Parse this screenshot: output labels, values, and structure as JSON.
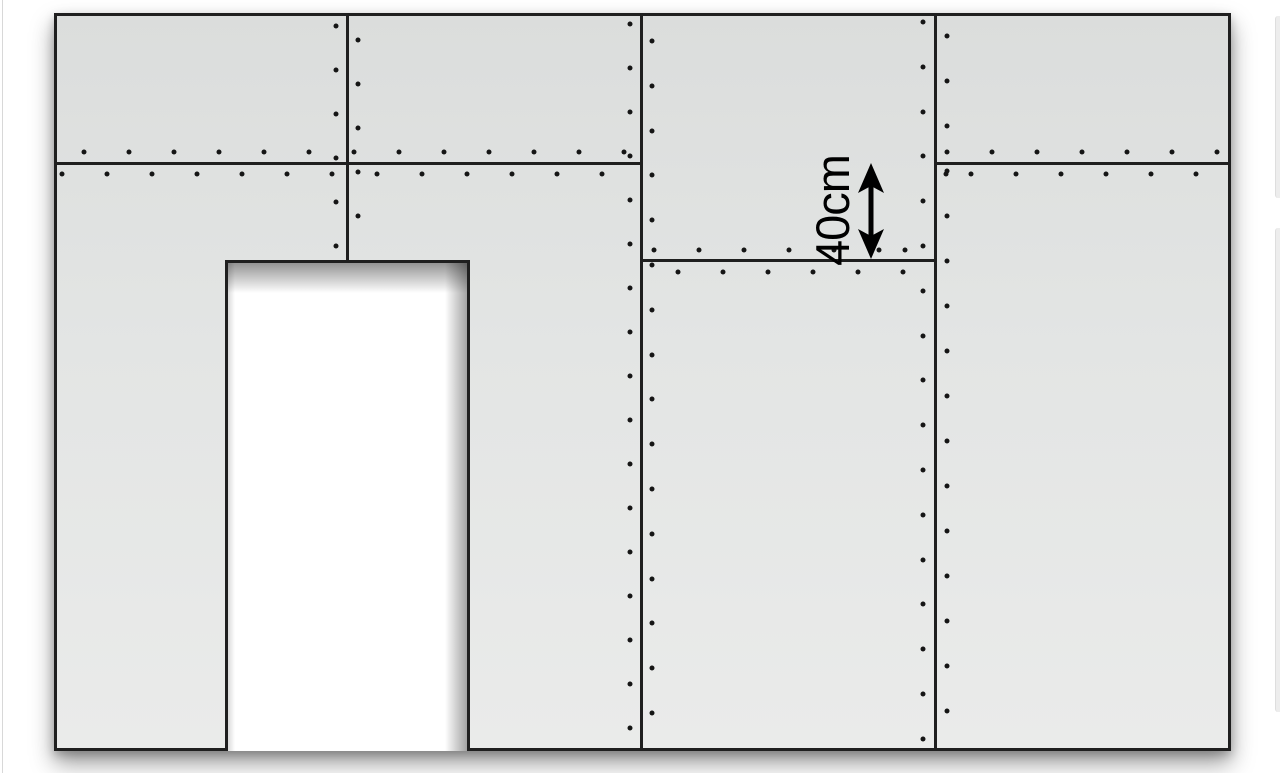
{
  "dimension": {
    "label": "40cm"
  },
  "diagram": {
    "canvas": {
      "width": 1280,
      "height": 773,
      "background": "#ffffff"
    },
    "wall": {
      "x": 54,
      "y": 13,
      "width": 1177,
      "height": 738,
      "fill_top": "#dbdddc",
      "fill_mid": "#e3e5e4",
      "fill_bottom": "#eaebea",
      "line_color": "#1f1f1f",
      "line_width": 3,
      "shadow": "0 12px 22px rgba(0,0,0,0.40), 0 4px 9px rgba(0,0,0,0.22)"
    },
    "door": {
      "x": 225,
      "y": 260,
      "width": 245,
      "height": 491,
      "fill": "#ffffff"
    },
    "seams": [
      {
        "orientation": "vertical",
        "pos": 347,
        "from": 13,
        "to": 260
      },
      {
        "orientation": "vertical",
        "pos": 641,
        "from": 13,
        "to": 751
      },
      {
        "orientation": "vertical",
        "pos": 935,
        "from": 13,
        "to": 751
      },
      {
        "orientation": "horizontal",
        "pos": 163,
        "from": 54,
        "to": 641
      },
      {
        "orientation": "horizontal",
        "pos": 163,
        "from": 935,
        "to": 1231
      },
      {
        "orientation": "horizontal",
        "pos": 260,
        "from": 641,
        "to": 935
      }
    ],
    "screws": {
      "color": "#151515",
      "diameter": 5,
      "rows": [
        {
          "axis": "x",
          "at": 152,
          "start": 84,
          "step": 45,
          "count": 13
        },
        {
          "axis": "x",
          "at": 174,
          "start": 62,
          "step": 45,
          "count": 13
        },
        {
          "axis": "x",
          "at": 152,
          "start": 947,
          "step": 45,
          "count": 7
        },
        {
          "axis": "x",
          "at": 174,
          "start": 946,
          "step": 45,
          "count": 1
        },
        {
          "axis": "x",
          "at": 174,
          "start": 971,
          "step": 45,
          "count": 6
        },
        {
          "axis": "x",
          "at": 250,
          "start": 654,
          "step": 45,
          "count": 6
        },
        {
          "axis": "x",
          "at": 250,
          "start": 905,
          "step": 45,
          "count": 1
        },
        {
          "axis": "x",
          "at": 272,
          "start": 678,
          "step": 45,
          "count": 6
        },
        {
          "axis": "y",
          "at": 336,
          "start": 26,
          "step": 44,
          "count": 6
        },
        {
          "axis": "y",
          "at": 358,
          "start": 40,
          "step": 44,
          "count": 5
        },
        {
          "axis": "y",
          "at": 630,
          "start": 24,
          "step": 44,
          "count": 17
        },
        {
          "axis": "y",
          "at": 652,
          "start": 41,
          "step": 44.8,
          "count": 16
        },
        {
          "axis": "y",
          "at": 923,
          "start": 22,
          "step": 44.8,
          "count": 17
        },
        {
          "axis": "y",
          "at": 947,
          "start": 36,
          "step": 45,
          "count": 16
        }
      ]
    },
    "dimension_arrow": {
      "x": 871,
      "top": 162,
      "bottom": 260,
      "head_width": 26,
      "head_length": 30,
      "notch": 7,
      "shaft_width": 5,
      "color": "#000000",
      "label_center_x": 833,
      "label_center_y": 211
    },
    "page_artifacts": {
      "left_edge_line": {
        "x": 2,
        "color": "#d8d8d8"
      },
      "sliver_color": "#ededed",
      "right_slivers": [
        {
          "y": 16,
          "height": 182
        },
        {
          "y": 228,
          "height": 484
        }
      ]
    }
  }
}
